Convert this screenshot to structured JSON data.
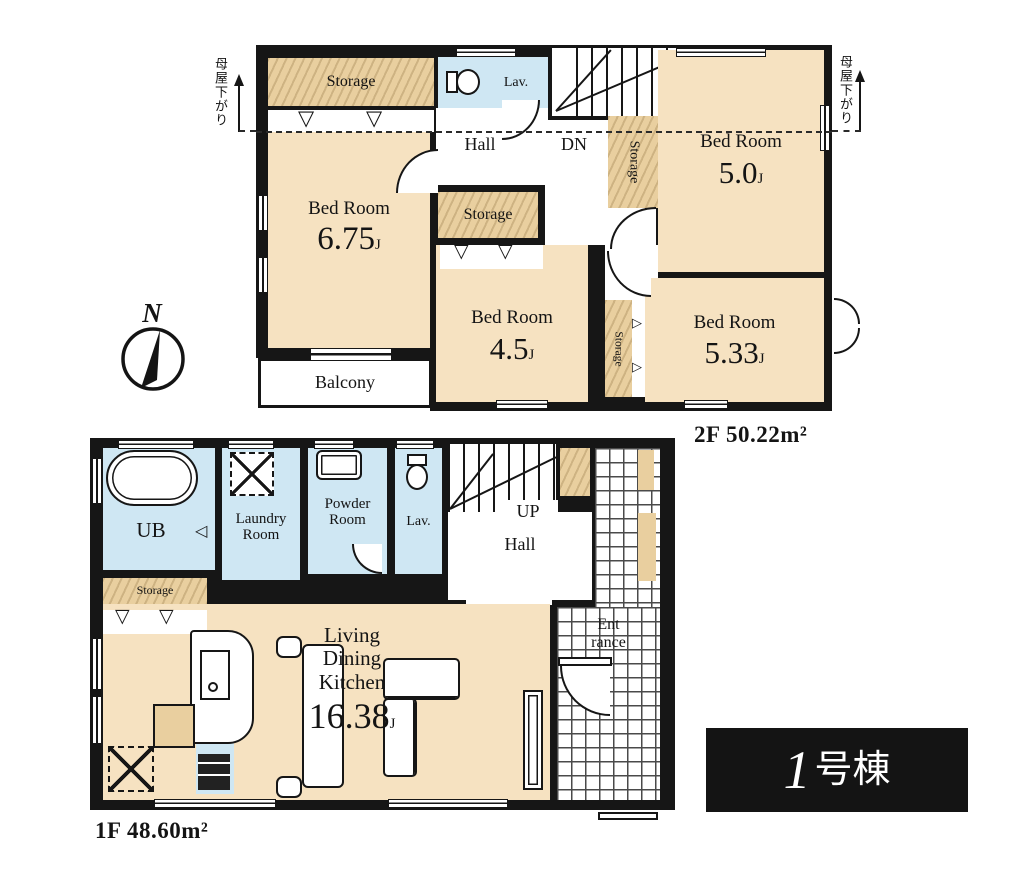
{
  "compass": {
    "label": "N"
  },
  "roof_notes": {
    "left": "母屋下がり",
    "right": "母屋下がり"
  },
  "floor2": {
    "area": "2F 50.22m²",
    "storage_nw": "Storage",
    "lav": "Lav.",
    "hall": "Hall",
    "dn": "DN",
    "storage_center": "Storage",
    "storage_mid": "Storage",
    "storage_se": "Storage",
    "balcony": "Balcony",
    "bed_ne": {
      "name": "Bed Room",
      "size": "5.0",
      "unit": "J"
    },
    "bed_w": {
      "name": "Bed Room",
      "size": "6.75",
      "unit": "J"
    },
    "bed_s": {
      "name": "Bed Room",
      "size": "4.5",
      "unit": "J"
    },
    "bed_se": {
      "name": "Bed Room",
      "size": "5.33",
      "unit": "J"
    }
  },
  "floor1": {
    "area": "1F 48.60m²",
    "ub": "UB",
    "laundry": "Laundry Room",
    "powder": "Powder Room",
    "lav": "Lav.",
    "up": "UP",
    "hall": "Hall",
    "storage": "Storage",
    "entrance_l1": "Ent",
    "entrance_l2": "rance",
    "ldk": {
      "l1": "Living",
      "l2": "Dining",
      "l3": "Kitchen",
      "size": "16.38",
      "unit": "J"
    }
  },
  "title": {
    "number": "1",
    "suffix": "号棟"
  }
}
